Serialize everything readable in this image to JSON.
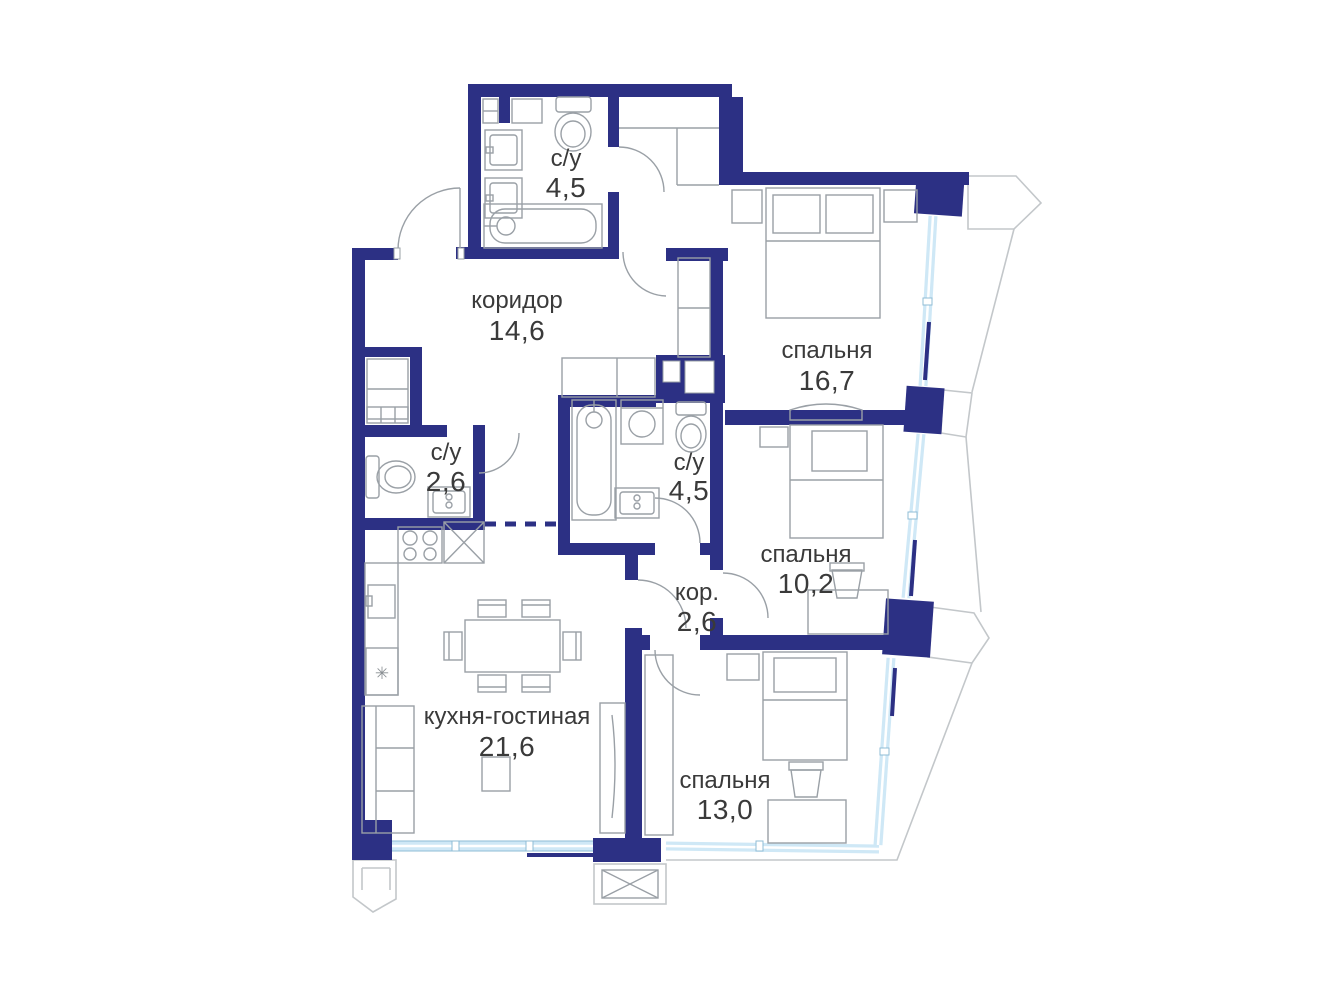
{
  "plan": {
    "rooms": [
      {
        "id": "bathroom-top",
        "name": "с/у",
        "area": "4,5"
      },
      {
        "id": "corridor",
        "name": "коридор",
        "area": "14,6"
      },
      {
        "id": "bedroom-1",
        "name": "спальня",
        "area": "16,7"
      },
      {
        "id": "wc-small",
        "name": "с/у",
        "area": "2,6"
      },
      {
        "id": "bathroom-mid",
        "name": "с/у",
        "area": "4,5"
      },
      {
        "id": "bedroom-2",
        "name": "спальня",
        "area": "10,2"
      },
      {
        "id": "hall-small",
        "name": "кор.",
        "area": "2,6"
      },
      {
        "id": "kitchen-living",
        "name": "кухня-гостиная",
        "area": "21,6"
      },
      {
        "id": "bedroom-3",
        "name": "спальня",
        "area": "13,0"
      }
    ],
    "colors": {
      "wall": "#2c3084",
      "furniture": "#9aa0a6",
      "outline": "#c3c7ca",
      "window": "#cfe8f6",
      "window-edge": "#8fbcd6",
      "text": "#3a3a3a",
      "bg": "#ffffff"
    }
  }
}
